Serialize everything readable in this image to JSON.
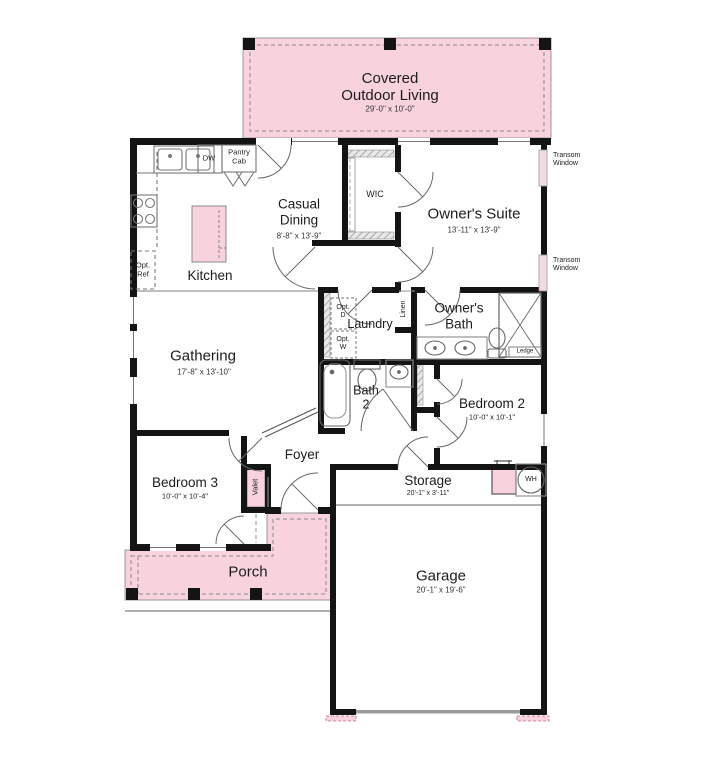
{
  "colors": {
    "area_pink": "#f8d3de",
    "window_pink": "#f2dbe3",
    "wall": "#141414",
    "fixture_line": "#8a8a8a",
    "text": "#1c1c1c"
  },
  "rooms": {
    "covered_outdoor_living": {
      "name": "Covered\nOutdoor Living",
      "dims": "29'-0\" x 10'-0\""
    },
    "casual_dining": {
      "name": "Casual\nDining",
      "dims": "8'-8\" x 13'-9\""
    },
    "owners_suite": {
      "name": "Owner's Suite",
      "dims": "13'-11\" x 13'-9\""
    },
    "kitchen": {
      "name": "Kitchen"
    },
    "wic": {
      "name": "WIC"
    },
    "laundry": {
      "name": "Laundry"
    },
    "owners_bath": {
      "name": "Owner's\nBath"
    },
    "gathering": {
      "name": "Gathering",
      "dims": "17'-8\" x 13'-10\""
    },
    "bath2": {
      "name": "Bath\n2"
    },
    "bedroom2": {
      "name": "Bedroom 2",
      "dims": "10'-0\" x 10'-1\""
    },
    "foyer": {
      "name": "Foyer"
    },
    "bedroom3": {
      "name": "Bedroom 3",
      "dims": "10'-0\" x 10'-4\""
    },
    "porch": {
      "name": "Porch"
    },
    "storage": {
      "name": "Storage",
      "dims": "20'-1\" x 3'-11\""
    },
    "garage": {
      "name": "Garage",
      "dims": "20'-1\" x 19'-6\""
    }
  },
  "annotations": {
    "transom_window_upper": "Transom\nWindow",
    "transom_window_lower": "Transom\nWindow",
    "dw": "DW",
    "pantry_cab": "Pantry\nCab",
    "opt_ref": "Opt.\nRef",
    "opt_d": "Opt.\nD",
    "opt_w": "Opt.\nW",
    "linen": "Linen",
    "valet": "Valet",
    "ledge": "Ledge",
    "wh": "WH"
  }
}
